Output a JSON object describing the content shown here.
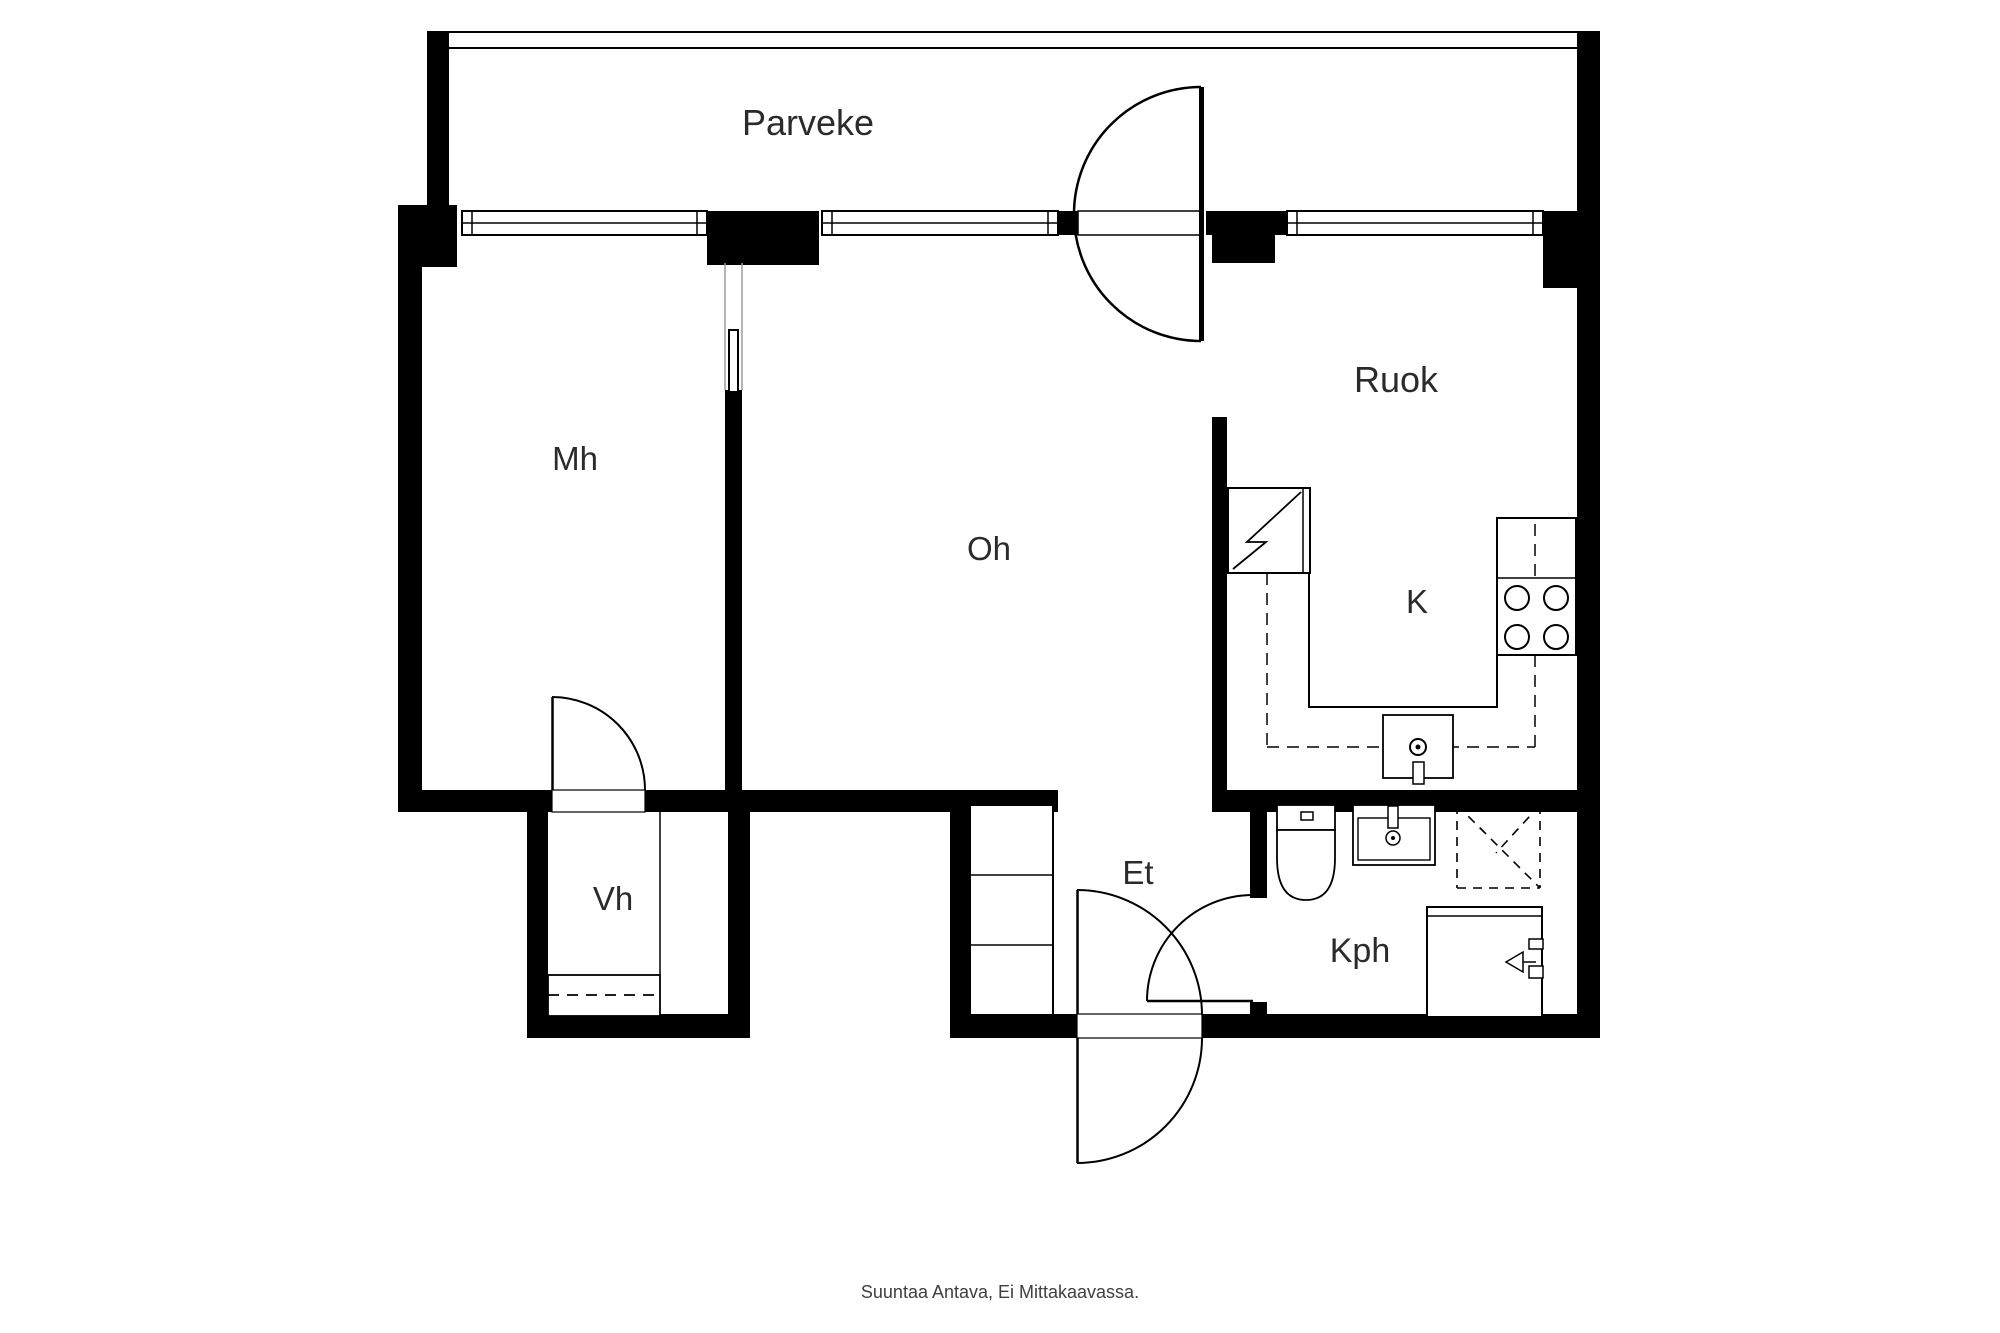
{
  "plan": {
    "title": "Floor plan",
    "rooms": [
      {
        "id": "parveke",
        "label": "Parveke"
      },
      {
        "id": "mh",
        "label": "Mh"
      },
      {
        "id": "oh",
        "label": "Oh"
      },
      {
        "id": "ruok",
        "label": "Ruok"
      },
      {
        "id": "k",
        "label": "K"
      },
      {
        "id": "vh",
        "label": "Vh"
      },
      {
        "id": "et",
        "label": "Et"
      },
      {
        "id": "kph",
        "label": "Kph"
      }
    ],
    "footer": "Suuntaa Antava, Ei Mittakaavassa.",
    "fixtures": [
      "fridge",
      "stove-4-burners",
      "kitchen-sink",
      "toilet",
      "washbasin",
      "shower",
      "washing-machine",
      "hall-closet",
      "wardrobe",
      "balcony-door",
      "entrance-door",
      "bathroom-door",
      "vh-door",
      "windows"
    ],
    "colors": {
      "wall": "#000000",
      "line": "#000000",
      "light_line": "#9a9a9a",
      "background": "#ffffff",
      "text": "#2b2b2b",
      "footer_text": "#3f3f3f"
    }
  }
}
